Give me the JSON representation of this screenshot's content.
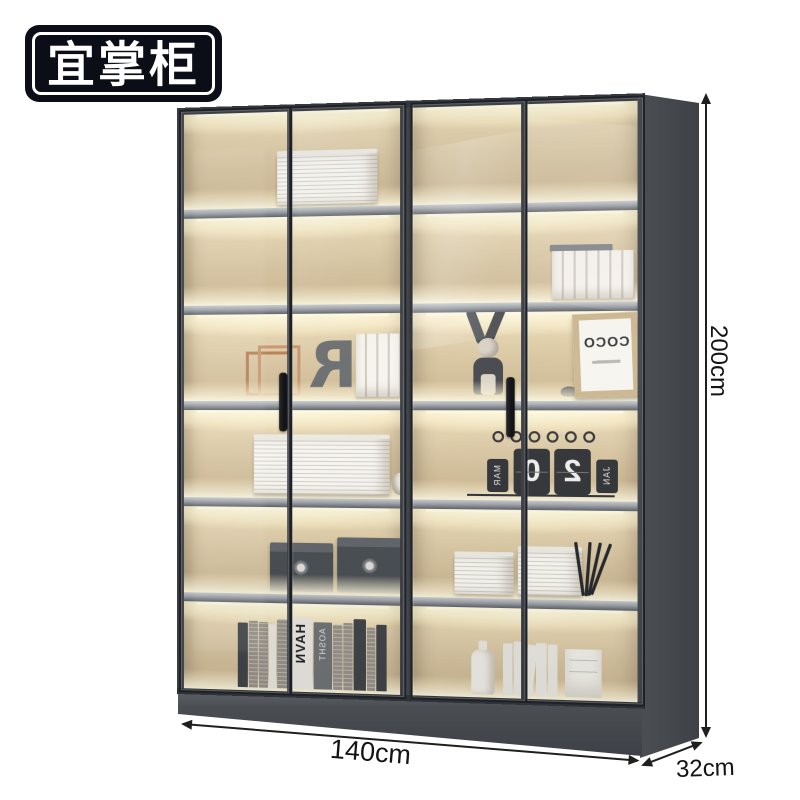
{
  "brand": {
    "logo_text": "宜掌柜"
  },
  "product": {
    "type": "glass-door bookcase display cabinet with LED shelf lighting",
    "annotations": {
      "height_label": "200cm",
      "width_label": "140cm",
      "depth_label": "32cm"
    }
  },
  "decor_text": {
    "mirrored_letter": "R",
    "mirrored_book_title": "HIRA",
    "frame_print": "COCO",
    "calendar_digit_left": "2",
    "calendar_digit_right": "0",
    "calendar_tab_left": "JAN",
    "calendar_tab_right": "MAR",
    "spine_text_a": "HAVN",
    "spine_text_b": "AOSHT"
  },
  "colors": {
    "frame": "#3a3d42",
    "side_panel": "#45494e",
    "interior": "#d7c39d",
    "led_glow": "#fff3cb",
    "shelf_edge": "#9da1a6",
    "logo_bg": "#0b0d17",
    "dimension_ink": "#1f1f1f"
  }
}
